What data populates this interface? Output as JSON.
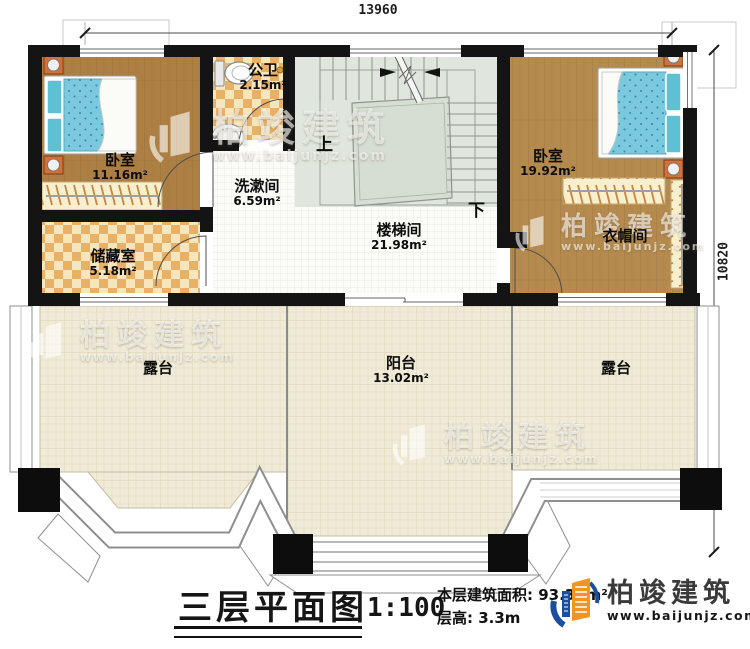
{
  "plan": {
    "dimensions": {
      "width_mm": "13960",
      "height_mm": "10820"
    },
    "rooms": [
      {
        "id": "bedroom-left",
        "name": "卧室",
        "area": "11.16m²"
      },
      {
        "id": "bathroom",
        "name": "公卫",
        "area": "2.15m²"
      },
      {
        "id": "washroom",
        "name": "洗漱间",
        "area": "6.59m²"
      },
      {
        "id": "storage",
        "name": "储藏室",
        "area": "5.18m²"
      },
      {
        "id": "stairwell",
        "name": "楼梯间",
        "area": "21.98m²"
      },
      {
        "id": "bedroom-right",
        "name": "卧室",
        "area": "19.92m²"
      },
      {
        "id": "cloakroom",
        "name": "衣帽间",
        "area": ""
      },
      {
        "id": "terrace-left",
        "name": "露台",
        "area": ""
      },
      {
        "id": "balcony",
        "name": "阳台",
        "area": "13.02m²"
      },
      {
        "id": "terrace-right",
        "name": "露台",
        "area": ""
      }
    ],
    "stairs": {
      "up_label": "上",
      "down_label": "下"
    }
  },
  "title_block": {
    "title": "三层平面图",
    "scale": "1:100",
    "floor_area": "本层建筑面积: 93.36m²",
    "floor_height": "层高: 3.3m"
  },
  "branding": {
    "logo_text": "柏竣建筑",
    "logo_url": "www.baijunjz.com"
  },
  "watermark": {
    "text": "柏竣建筑",
    "url": "www.baijunjz.com"
  },
  "colors": {
    "wall": "#141414",
    "wood_floor": "#b08347",
    "checker_tile": "#e9b165",
    "stair_floor": "#e0e6dd",
    "terrace_floor": "#f0ebd8",
    "mattress_blue": "#7ac9de",
    "logo_blue": "#1c4e9e",
    "logo_orange": "#f29422"
  }
}
